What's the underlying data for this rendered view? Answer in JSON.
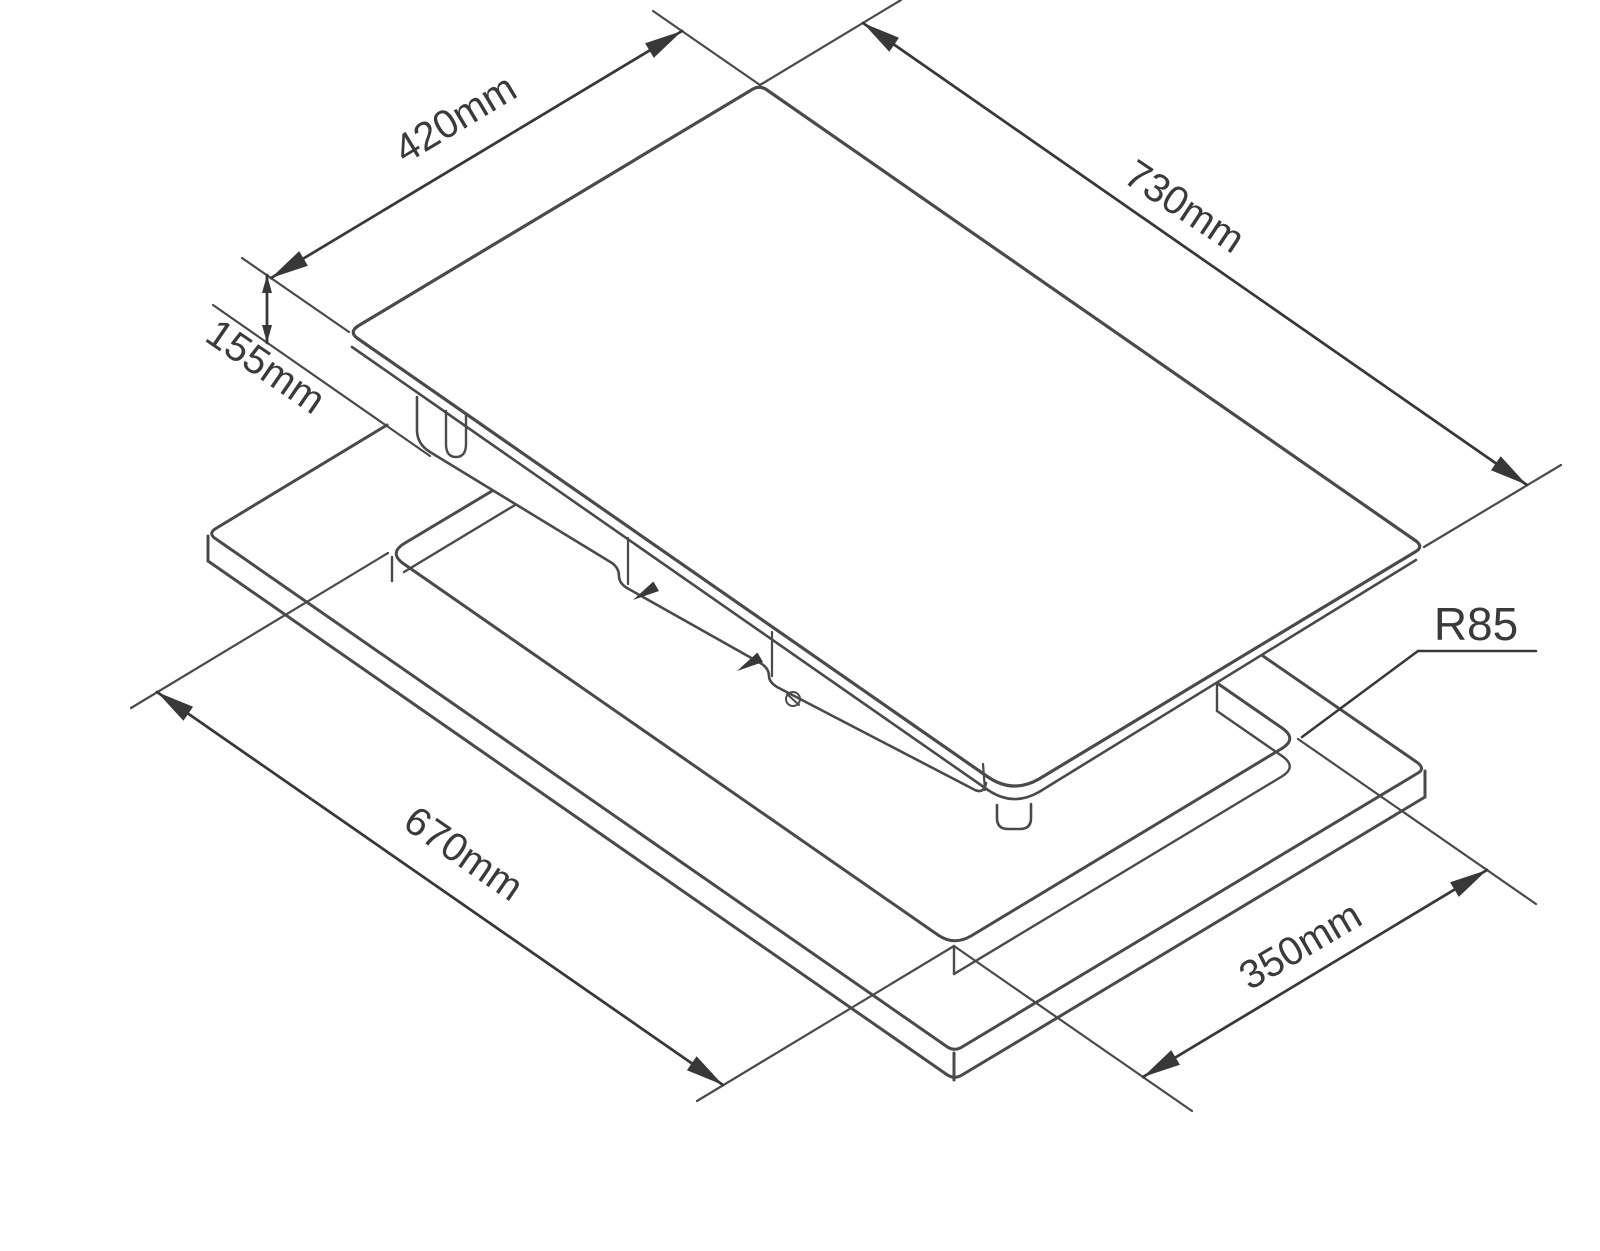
{
  "page": {
    "width": 1600,
    "height": 1251,
    "background": "#ffffff"
  },
  "drawing": {
    "type": "isometric installation diagram",
    "subject": "built-in hob above worktop cutout",
    "colors": {
      "body_line": "#4a4a4a",
      "dim_line": "#383838",
      "text": "#3a3a3a",
      "background": "#ffffff"
    },
    "dimensions": [
      {
        "id": "dim-420",
        "label": "420mm",
        "line": [
          271,
          278,
          682,
          31
        ],
        "label_pos": [
          455,
          118
        ],
        "label_rot": -31,
        "font_size": 40,
        "small": false,
        "ext": [
          [
            242,
            258,
            349,
            332
          ],
          [
            653,
            11,
            760,
            85
          ]
        ]
      },
      {
        "id": "dim-730",
        "label": "730mm",
        "line": [
          863,
          23,
          1527,
          485
        ],
        "label_pos": [
          1185,
          206
        ],
        "label_rot": 33.5,
        "font_size": 40,
        "small": false,
        "ext": [
          [
            760,
            85,
            901,
            0
          ],
          [
            1424,
            547,
            1561,
            465
          ]
        ]
      },
      {
        "id": "dim-155",
        "label": "155mm",
        "line": [
          267,
          275,
          267,
          343
        ],
        "label_pos": [
          266,
          366
        ],
        "label_rot": 34.5,
        "font_size": 40,
        "small": true,
        "ext": [
          [
            213,
            305,
            430,
            456
          ]
        ]
      },
      {
        "id": "dim-670",
        "label": "670mm",
        "line": [
          157,
          692,
          723,
          1085
        ],
        "label_pos": [
          464,
          853
        ],
        "label_rot": 34.5,
        "font_size": 40,
        "small": false,
        "ext": [
          [
            388,
            553,
            131,
            708
          ],
          [
            954,
            946,
            697,
            1101
          ]
        ]
      },
      {
        "id": "dim-350",
        "label": "350mm",
        "line": [
          1143,
          1077,
          1487,
          870
        ],
        "label_pos": [
          1300,
          945
        ],
        "label_rot": -30.5,
        "font_size": 40,
        "small": false,
        "ext": [
          [
            954,
            946,
            1192,
            1111
          ],
          [
            1298,
            739,
            1536,
            904
          ]
        ]
      }
    ],
    "radius_callout": {
      "id": "callout-r85",
      "label": "R85",
      "label_pos": [
        1476,
        624
      ],
      "font_size": 46,
      "underline": [
        1418,
        651,
        1536,
        651
      ],
      "leader": [
        1418,
        651,
        1302,
        737
      ]
    },
    "paths": [
      {
        "name": "glass-top-face",
        "d": "M 753,89 L 358,326 Q 349,332 357,338 L 988,777 Q 1013,794 1039,779 L 1415,552 Q 1424,547 1416,541 L 767,90 Q 760,85 753,89 Z",
        "fill": "#ffffff",
        "w": 3.2
      },
      {
        "name": "glass-front-edge",
        "d": "M 352,347 L 988,790 Q 1013,807 1039,792 L 1416,560",
        "fill": "none",
        "w": 2.6
      },
      {
        "name": "glass-foot",
        "d": "M 997,805 L 997,818 Q 997,829 1008,829 L 1020,829 Q 1031,829 1031,818 L 1031,804",
        "fill": "none",
        "w": 2.6
      },
      {
        "name": "chassis-outline",
        "d": "M 417,397 L 417,430 Q 417,444 430,452 L 612,563 Q 619,568 619,576 Q 619,583 627,588 L 762,664 Q 769,669 769,676 Q 769,682 777,687 L 975,790 Q 984,794 986,783",
        "fill": "none",
        "w": 2.6
      },
      {
        "name": "chassis-tab",
        "d": "M 446,411 L 446,444 Q 446,457 456,457 Q 466,457 466,444 L 466,415",
        "fill": "none",
        "w": 2.4
      },
      {
        "name": "chassis-tick-1",
        "d": "M 628,538 L 628,584",
        "fill": "none",
        "w": 2.2
      },
      {
        "name": "chassis-tick-2",
        "d": "M 772,632 L 772,676",
        "fill": "none",
        "w": 2.2
      },
      {
        "name": "chassis-tick-3",
        "d": "M 983,764 L 985,790",
        "fill": "none",
        "w": 2.2
      },
      {
        "name": "screw-icon",
        "d": "M 786,699 A 7,7 0 1 0 800,699 A 7,7 0 1 0 786,699 M 787,694 L 799,705",
        "fill": "none",
        "w": 2
      },
      {
        "name": "countertop-top-face",
        "d": "M 387,425 L 215,529 Q 208,534 216,539 L 946,1046 Q 954,1052 962,1047 L 1418,773 Q 1425,769 1418,763 L 1263,656",
        "fill": "none",
        "w": 3
      },
      {
        "name": "countertop-corner-left",
        "d": "M 208,536 L 208,561",
        "fill": "none",
        "w": 3
      },
      {
        "name": "countertop-corner-front",
        "d": "M 954,1053 L 954,1080",
        "fill": "none",
        "w": 3
      },
      {
        "name": "countertop-corner-right",
        "d": "M 1425,771 L 1425,797",
        "fill": "none",
        "w": 3
      },
      {
        "name": "countertop-bottom-edge",
        "d": "M 208,561 L 946,1074 Q 954,1080 962,1075 L 1425,797",
        "fill": "none",
        "w": 3
      },
      {
        "name": "cutout-rim",
        "d": "M 492,491 L 405,543 Q 388,553 404,564 L 938,935 Q 954,946 971,936 L 1281,749 Q 1298,739 1282,728 L 1217,683",
        "fill": "none",
        "w": 3
      },
      {
        "name": "cutout-wall-back-left",
        "d": "M 515,505 L 404,572",
        "fill": "none",
        "w": 2.4
      },
      {
        "name": "cutout-wall-tick-left",
        "d": "M 392,557 L 392,581",
        "fill": "none",
        "w": 2.4
      },
      {
        "name": "cutout-wall-front-right",
        "d": "M 954,974 L 1281,777 Q 1298,767 1282,756 L 1217,711",
        "fill": "none",
        "w": 2.4
      },
      {
        "name": "cutout-wall-tick-front",
        "d": "M 954,946 L 954,974",
        "fill": "none",
        "w": 2.4
      },
      {
        "name": "cutout-wall-tick-right",
        "d": "M 1217,683 L 1217,711",
        "fill": "none",
        "w": 2.4
      }
    ],
    "markers": [
      {
        "name": "clip-arrow-1",
        "tip": [
          633,
          600
        ],
        "from": [
          660,
          584
        ]
      },
      {
        "name": "clip-arrow-2",
        "tip": [
          737,
          671
        ],
        "from": [
          764,
          655
        ]
      }
    ]
  }
}
